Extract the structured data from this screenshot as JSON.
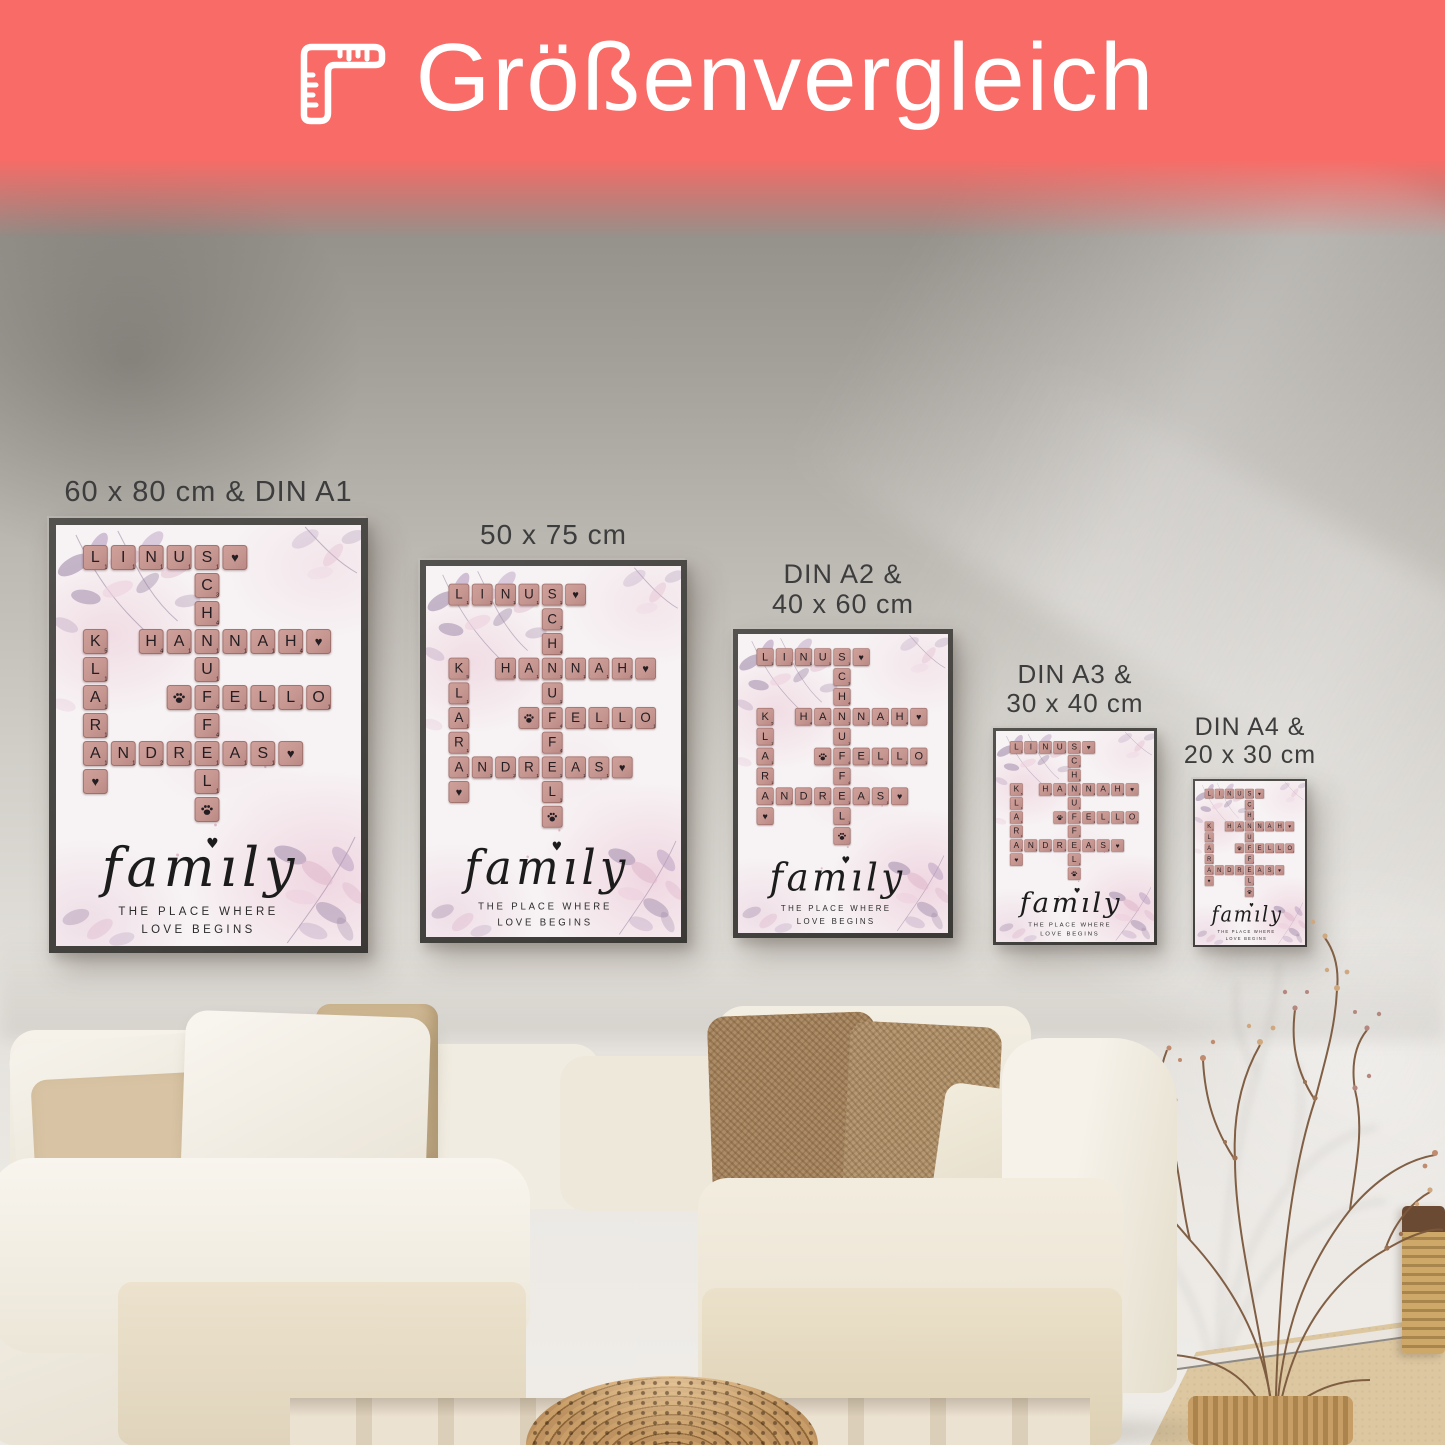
{
  "banner": {
    "title": "Größenvergleich",
    "bg_color": "#f96b66",
    "text_color": "#ffffff",
    "icon": "folding-ruler-icon"
  },
  "posters": [
    {
      "id": "size-60x80-din-a1",
      "label_lines": [
        "60 x 80 cm & DIN A1"
      ],
      "x": 49,
      "y": 518,
      "width": 319,
      "height": 435,
      "label_font": 29
    },
    {
      "id": "size-50x75",
      "label_lines": [
        "50 x 75 cm"
      ],
      "x": 420,
      "y": 560,
      "width": 267,
      "height": 383,
      "label_font": 28
    },
    {
      "id": "size-din-a2-40x60",
      "label_lines": [
        "DIN A2 &",
        "40 x 60 cm"
      ],
      "x": 733,
      "y": 629,
      "width": 220,
      "height": 309,
      "label_font": 27
    },
    {
      "id": "size-din-a3-30x40",
      "label_lines": [
        "DIN A3 &",
        "30 x 40 cm"
      ],
      "x": 993,
      "y": 728,
      "width": 164,
      "height": 217,
      "label_font": 26
    },
    {
      "id": "size-din-a4-20x30",
      "label_lines": [
        "DIN A4 &",
        "20 x 30 cm"
      ],
      "x": 1193,
      "y": 779,
      "width": 114,
      "height": 168,
      "label_font": 25
    }
  ],
  "poster_design": {
    "names": [
      "LINUS",
      "SCHNUFFEL",
      "HANNAH",
      "KLARA",
      "FELLO",
      "ANDREAS"
    ],
    "script_title": "family",
    "subtitle_lines": [
      "THE PLACE WHERE",
      "LOVE BEGINS"
    ],
    "heart_glyph": "♥",
    "tile_color": "#c69691",
    "tile_text_color": "#241d21",
    "frame_color": "#3b3936",
    "background_color": "#f7f3f4",
    "tiles": [
      {
        "r": 0,
        "c": 0,
        "t": "l",
        "ch": "L",
        "v": "1"
      },
      {
        "r": 0,
        "c": 1,
        "t": "l",
        "ch": "I",
        "v": "1"
      },
      {
        "r": 0,
        "c": 2,
        "t": "l",
        "ch": "N",
        "v": "1"
      },
      {
        "r": 0,
        "c": 3,
        "t": "l",
        "ch": "U",
        "v": "1"
      },
      {
        "r": 0,
        "c": 4,
        "t": "l",
        "ch": "S",
        "v": "1"
      },
      {
        "r": 0,
        "c": 5,
        "t": "h"
      },
      {
        "r": 1,
        "c": 4,
        "t": "l",
        "ch": "C",
        "v": "3"
      },
      {
        "r": 2,
        "c": 4,
        "t": "l",
        "ch": "H",
        "v": "4"
      },
      {
        "r": 3,
        "c": 0,
        "t": "l",
        "ch": "K",
        "v": "5"
      },
      {
        "r": 3,
        "c": 2,
        "t": "l",
        "ch": "H",
        "v": "4"
      },
      {
        "r": 3,
        "c": 3,
        "t": "l",
        "ch": "A",
        "v": "1"
      },
      {
        "r": 3,
        "c": 4,
        "t": "l",
        "ch": "N",
        "v": "1"
      },
      {
        "r": 3,
        "c": 5,
        "t": "l",
        "ch": "N",
        "v": "1"
      },
      {
        "r": 3,
        "c": 6,
        "t": "l",
        "ch": "A",
        "v": "1"
      },
      {
        "r": 3,
        "c": 7,
        "t": "l",
        "ch": "H",
        "v": "4"
      },
      {
        "r": 3,
        "c": 8,
        "t": "h"
      },
      {
        "r": 4,
        "c": 0,
        "t": "l",
        "ch": "L",
        "v": "1"
      },
      {
        "r": 4,
        "c": 4,
        "t": "l",
        "ch": "U",
        "v": "1"
      },
      {
        "r": 5,
        "c": 0,
        "t": "l",
        "ch": "A",
        "v": "1"
      },
      {
        "r": 5,
        "c": 3,
        "t": "p"
      },
      {
        "r": 5,
        "c": 4,
        "t": "l",
        "ch": "F",
        "v": "4"
      },
      {
        "r": 5,
        "c": 5,
        "t": "l",
        "ch": "E",
        "v": "1"
      },
      {
        "r": 5,
        "c": 6,
        "t": "l",
        "ch": "L",
        "v": "1"
      },
      {
        "r": 5,
        "c": 7,
        "t": "l",
        "ch": "L",
        "v": "1"
      },
      {
        "r": 5,
        "c": 8,
        "t": "l",
        "ch": "O",
        "v": "1"
      },
      {
        "r": 6,
        "c": 0,
        "t": "l",
        "ch": "R",
        "v": "1"
      },
      {
        "r": 6,
        "c": 4,
        "t": "l",
        "ch": "F",
        "v": "4"
      },
      {
        "r": 7,
        "c": 0,
        "t": "l",
        "ch": "A",
        "v": "1"
      },
      {
        "r": 7,
        "c": 1,
        "t": "l",
        "ch": "N",
        "v": "1"
      },
      {
        "r": 7,
        "c": 2,
        "t": "l",
        "ch": "D",
        "v": "2"
      },
      {
        "r": 7,
        "c": 3,
        "t": "l",
        "ch": "R",
        "v": "1"
      },
      {
        "r": 7,
        "c": 4,
        "t": "l",
        "ch": "E",
        "v": "1"
      },
      {
        "r": 7,
        "c": 5,
        "t": "l",
        "ch": "A",
        "v": "1"
      },
      {
        "r": 7,
        "c": 6,
        "t": "l",
        "ch": "S",
        "v": "1"
      },
      {
        "r": 7,
        "c": 7,
        "t": "h"
      },
      {
        "r": 8,
        "c": 0,
        "t": "h"
      },
      {
        "r": 8,
        "c": 4,
        "t": "l",
        "ch": "L",
        "v": "1"
      },
      {
        "r": 9,
        "c": 4,
        "t": "p"
      }
    ]
  },
  "scene": {
    "wall_color_top": "#8f8b85",
    "wall_color_bottom": "#f0ede9",
    "wood_floor_color": "#dcc7a1",
    "sofa_color": "#f3efe6",
    "pouf_color": "#bd9260"
  }
}
